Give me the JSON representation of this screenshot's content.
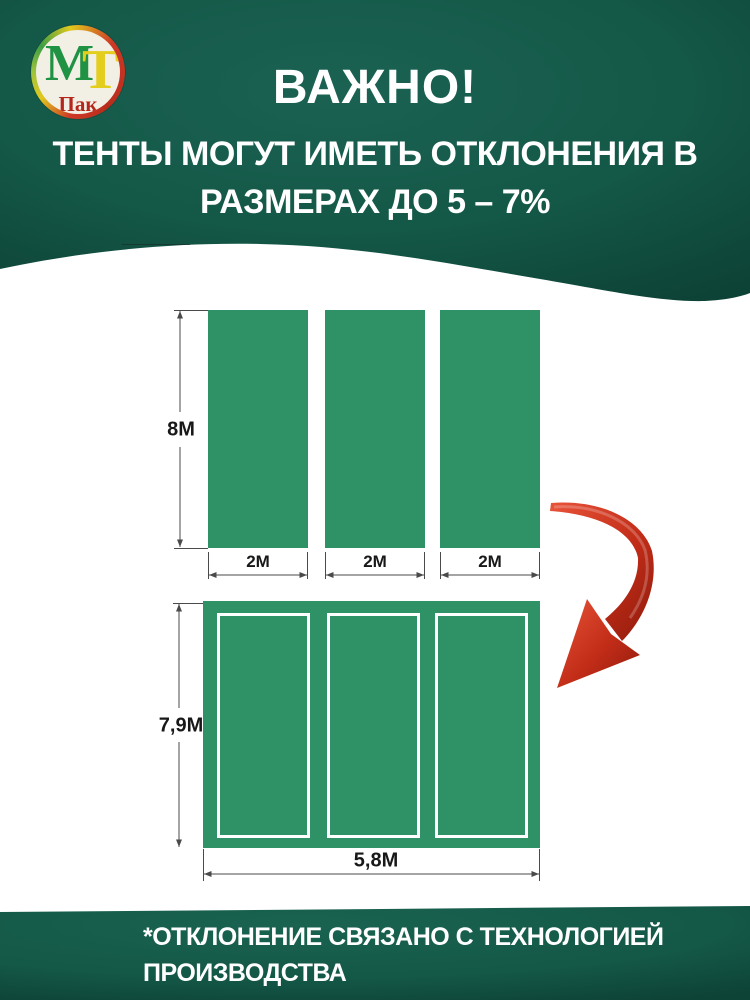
{
  "logo": {
    "letter_m": "М",
    "letter_t": "Т",
    "subtext": "Пак"
  },
  "header": {
    "title": "ВАЖНО!",
    "subtitle_line1": "ТЕНТЫ МОГУТ ИМЕТЬ ОТКЛОНЕНИЯ В",
    "subtitle_line2": "РАЗМЕРАХ ДО 5 – 7%"
  },
  "top_diagram": {
    "height_label": "8М",
    "width_labels": [
      "2М",
      "2М",
      "2М"
    ]
  },
  "bottom_diagram": {
    "height_label": "7,9М",
    "width_label": "5,8М"
  },
  "footer": {
    "note_line1": "*ОТКЛОНЕНИЕ СВЯЗАНО С ТЕХНОЛОГИЕЙ",
    "note_line2": "ПРОИЗВОДСТВА"
  },
  "colors": {
    "header_green": "#145847",
    "header_green_dark": "#0d4236",
    "tarp_green": "#2f9267",
    "arrow_red": "#c22d18",
    "text_white": "#ffffff",
    "dim_line": "#4a4a4a"
  }
}
